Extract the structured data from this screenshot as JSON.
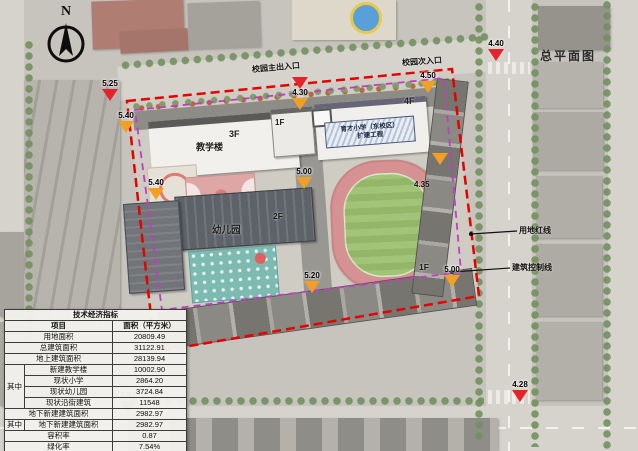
{
  "title": "总平面图",
  "compass": {
    "letter": "N"
  },
  "entrances": {
    "main": "校园主出入口",
    "secondary": "校园次入口"
  },
  "legend": {
    "red_line": "用地红线",
    "control_line": "建筑控制线"
  },
  "colors": {
    "land_red_line": "#e60000",
    "building_control_line": "#c23cc2",
    "marker_red": "#e3242b",
    "marker_orange": "#f2a024"
  },
  "buildings": {
    "teaching": "教学楼",
    "teaching_floors": "3F",
    "annex_floors": "1F",
    "main_name_line1": "育才小学（东校区）",
    "main_name_line2": "扩建工程",
    "main_floors": "4F",
    "kindergarten": "幼儿园",
    "kindergarten_floors": "2F",
    "street_floors": "1F"
  },
  "markers": [
    {
      "value": "5.25",
      "type": "red"
    },
    {
      "value": "5.40",
      "type": "orange"
    },
    {
      "value": "5.40",
      "type": "orange"
    },
    {
      "value": "4.30",
      "type": "red-orange"
    },
    {
      "value": "4.50",
      "type": "orange"
    },
    {
      "value": "4.40",
      "type": "red"
    },
    {
      "value": "5.00",
      "type": "orange"
    },
    {
      "value": "4.35",
      "type": "orange"
    },
    {
      "value": "5.20",
      "type": "orange"
    },
    {
      "value": "5.00",
      "type": "orange"
    },
    {
      "value": "4.87",
      "type": "red"
    },
    {
      "value": "4.28",
      "type": "red"
    }
  ],
  "table": {
    "title": "技术经济指标",
    "col_item": "项目",
    "col_area": "面积（平方米）",
    "among": "其中",
    "rows_top": [
      {
        "label": "用地面积",
        "value": "20809.49"
      },
      {
        "label": "总建筑面积",
        "value": "31122.91"
      },
      {
        "label": "地上建筑面积",
        "value": "28139.94"
      }
    ],
    "among_rows": [
      {
        "label": "新建教学楼",
        "value": "10002.90"
      },
      {
        "label": "现状小学",
        "value": "2864.20"
      },
      {
        "label": "现状幼儿园",
        "value": "3724.84"
      },
      {
        "label": "现状沿街建筑",
        "value": "11548"
      }
    ],
    "underground": {
      "label": "地下新建建筑面积",
      "value": "2982.97"
    },
    "among2": {
      "label": "地下新建建筑面积",
      "value": "2982.97"
    },
    "rows_bottom": [
      {
        "label": "容积率",
        "value": "0.87"
      },
      {
        "label": "绿化率",
        "value": "7.54%"
      },
      {
        "label": "建筑密度",
        "value": "53.20%"
      }
    ]
  }
}
